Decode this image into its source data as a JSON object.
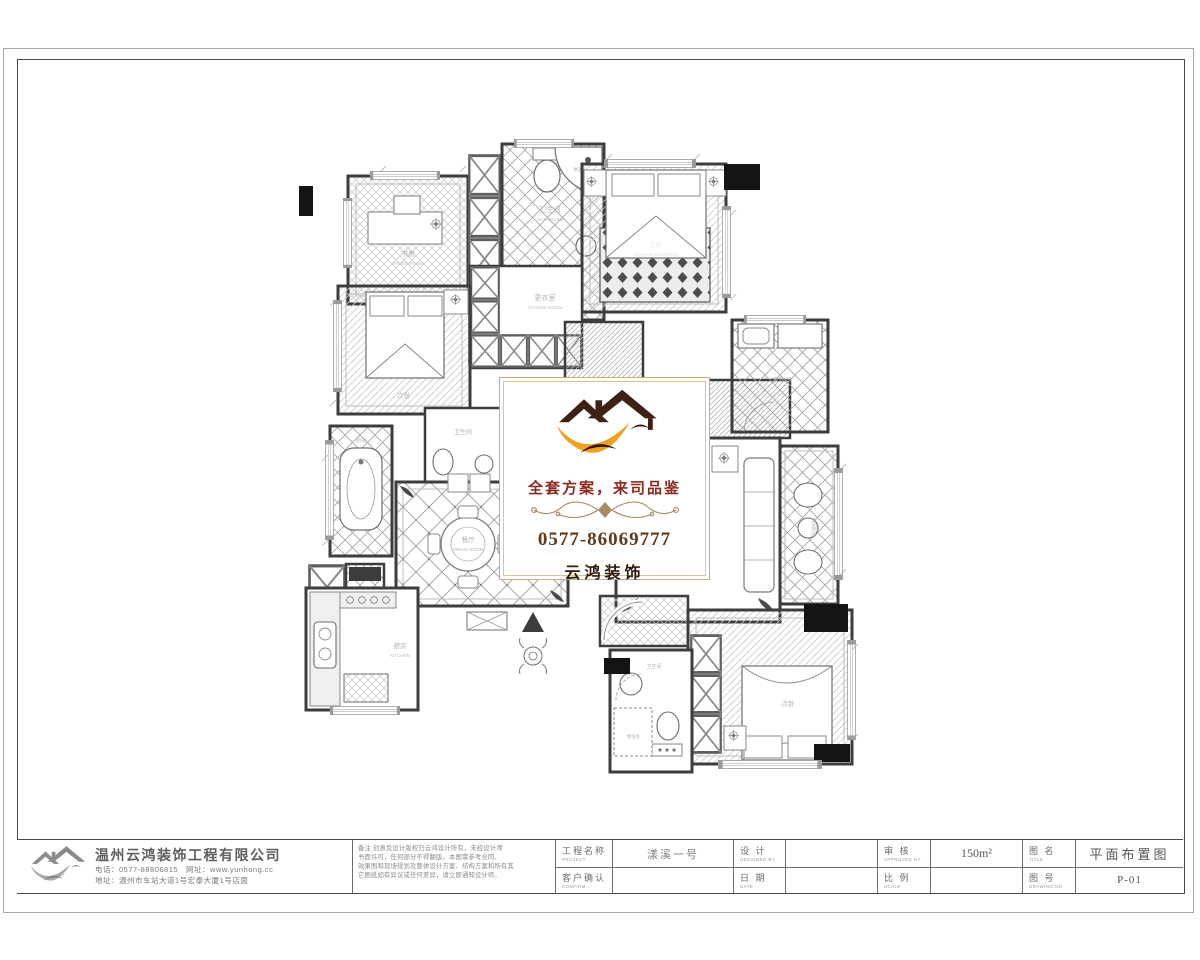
{
  "center_box": {
    "slogan": "全套方案，来司品鉴",
    "phone": "0577-86069777",
    "brand": "云鸿装饰"
  },
  "floorplan": {
    "rooms": [
      {
        "id": "study",
        "label": "书房",
        "sub": "STUDY ROOM"
      },
      {
        "id": "bath-top",
        "label": "卫生间",
        "sub": "BATHROOM"
      },
      {
        "id": "shower-top",
        "label": "淋浴房",
        "sub": ""
      },
      {
        "id": "master-bedroom",
        "label": "主卧",
        "sub": "MASTER BEDROOM"
      },
      {
        "id": "changeroom",
        "label": "更衣室",
        "sub": "CHANGE ROOM"
      },
      {
        "id": "bedroom-left",
        "label": "次卧",
        "sub": ""
      },
      {
        "id": "bath-middle",
        "label": "卫生间",
        "sub": ""
      },
      {
        "id": "balcony-left",
        "label": "阳台",
        "sub": ""
      },
      {
        "id": "dining",
        "label": "餐厅",
        "sub": "DINING ROOM"
      },
      {
        "id": "kitchen",
        "label": "厨房",
        "sub": "KITCHEN"
      },
      {
        "id": "service-balcony",
        "label": "生活阳台",
        "sub": ""
      },
      {
        "id": "laundry",
        "label": "家政间",
        "sub": ""
      },
      {
        "id": "leisure-balcony",
        "label": "休闲阳台",
        "sub": ""
      },
      {
        "id": "bedroom-bottom",
        "label": "次卧",
        "sub": ""
      },
      {
        "id": "bath-bottom",
        "label": "卫生间",
        "sub": ""
      },
      {
        "id": "shower-bottom",
        "label": "淋浴房",
        "sub": ""
      }
    ]
  },
  "titleblock": {
    "company": {
      "name": "温州云鸿装饰工程有限公司",
      "contact_line": "电话：0577-88806815　网址：www.yunhong.cc",
      "address_line": "地址：温州市车站大道1号宏泰大厦1号店面"
    },
    "notes": [
      "备注:创意及设计版权归云鸿设计所有，未经设计师",
      "书面许可，任何部分不得翻版。本图需参考合同、",
      "效果图和现场规划及整体设计方案、结构方案和所有其",
      "它图纸如有异议或任何差异，请立即通知设计师。"
    ],
    "fields": {
      "project_label": "工程名称",
      "project_label_en": "PROJECT",
      "project_value": "漾溪一号",
      "design_label": "设 计",
      "design_label_en": "DESIGNED BY",
      "design_value": "",
      "approve_label": "审 核",
      "approve_label_en": "APPROVED BY",
      "approve_value": "150m²",
      "title_label": "图 名",
      "title_label_en": "TITLE",
      "title_value": "平面布置图",
      "confirm_label": "客户确认",
      "confirm_label_en": "CONFIRM",
      "confirm_value": "",
      "date_label": "日 期",
      "date_label_en": "DATE",
      "date_value": "",
      "scale_label": "比 例",
      "scale_label_en": "SCALE",
      "scale_value": "",
      "no_label": "图 号",
      "no_label_en": "DRAWING NO",
      "no_value": "P-01"
    }
  }
}
